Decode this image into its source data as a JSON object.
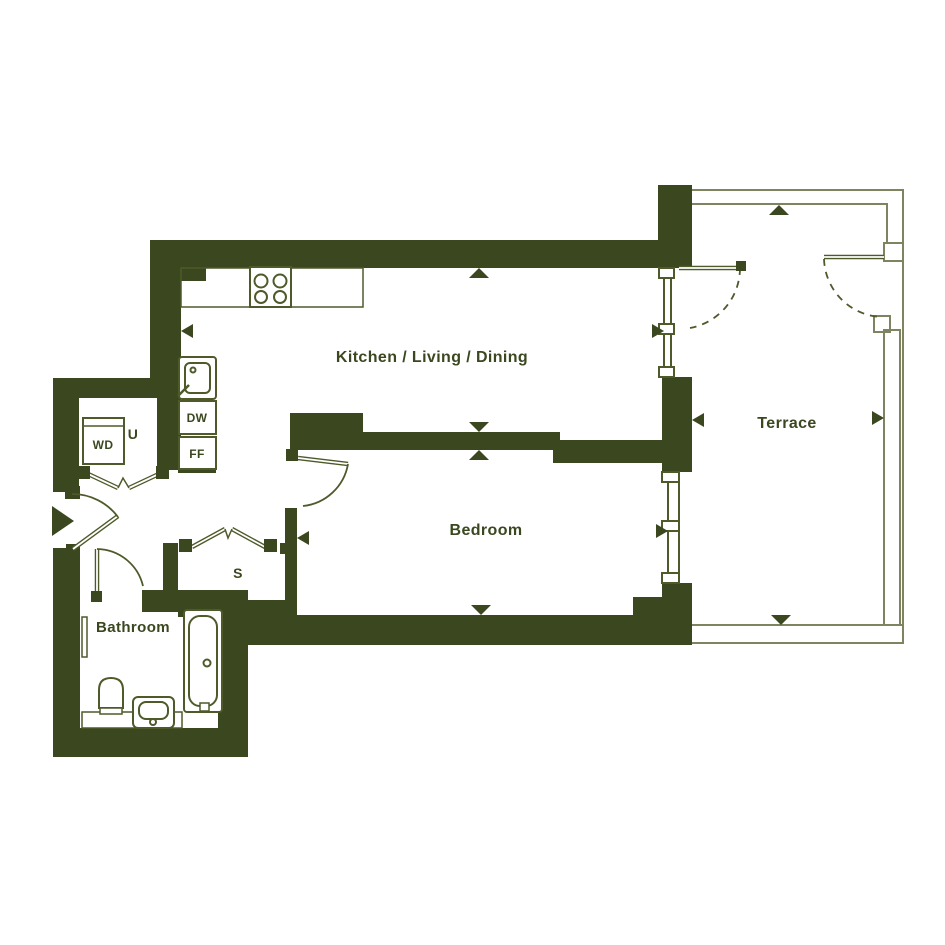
{
  "plan": {
    "type": "apartment-floor-plan",
    "rooms": {
      "kitchen": {
        "label": "Kitchen / Living / Dining"
      },
      "terrace": {
        "label": "Terrace"
      },
      "bedroom": {
        "label": "Bedroom"
      },
      "bathroom": {
        "label": "Bathroom"
      },
      "utility": {
        "label": "U"
      },
      "store": {
        "label": "S"
      }
    },
    "appliances": {
      "washer_dryer": {
        "label": "WD"
      },
      "dishwasher": {
        "label": "DW"
      },
      "fridge_freezer": {
        "label": "FF"
      }
    },
    "colors": {
      "wall": "#3b471f",
      "door_line": "#4e5a2a",
      "fixture_line": "#4e5a2a",
      "railing": "#7f8360",
      "text": "#3b471f",
      "background": "#ffffff"
    }
  }
}
